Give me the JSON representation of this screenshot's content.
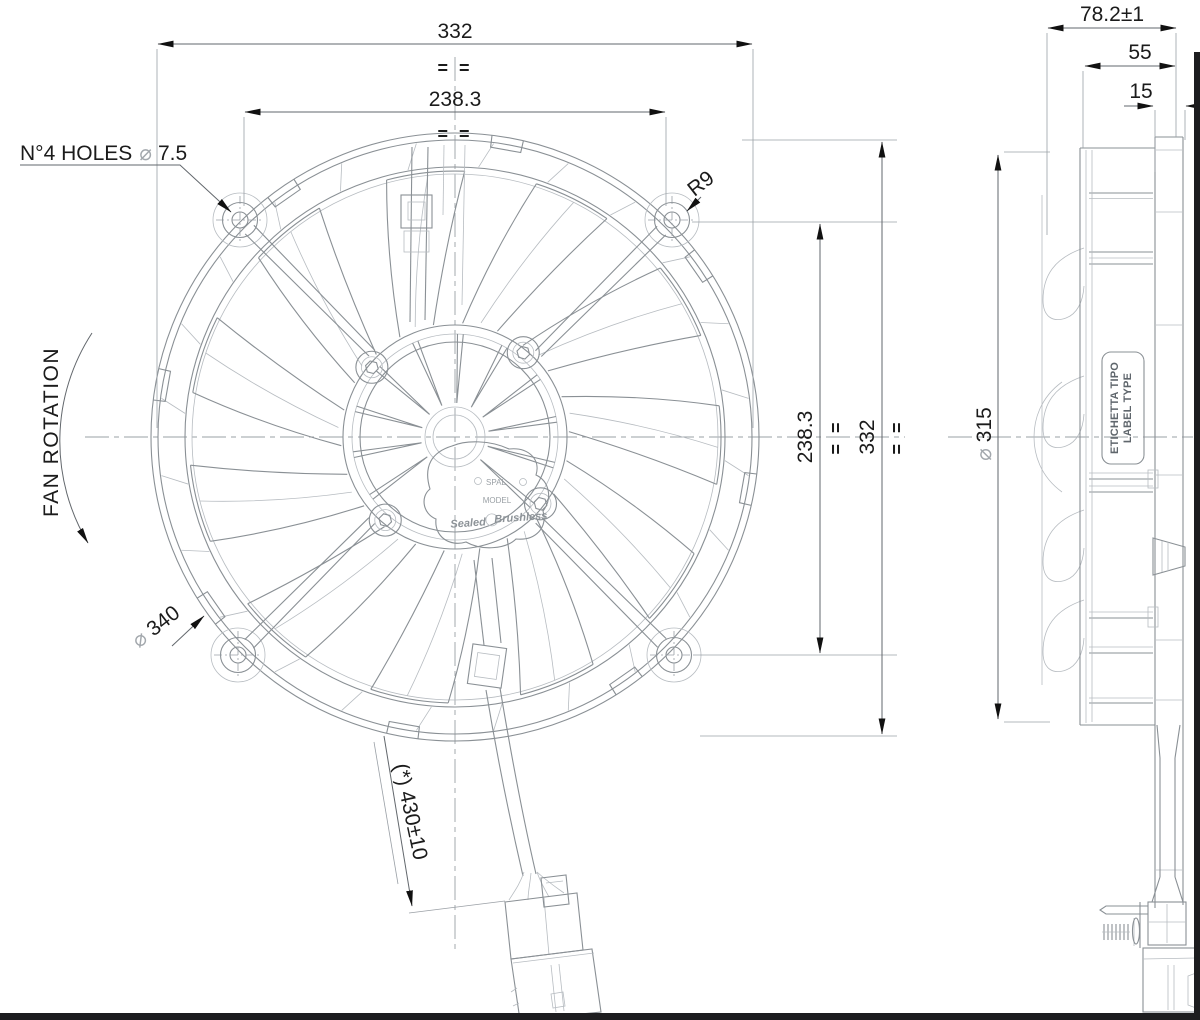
{
  "front_view": {
    "dim_width_outer": "332",
    "dim_width_holes": "238.3",
    "dim_height_holes": "238.3",
    "dim_height_outer": "332",
    "eq_mark": "= =",
    "holes_note_prefix": "N°4 HOLES",
    "dia_symbol": "⌀",
    "holes_note_value": "7.5",
    "corner_radius": "R9",
    "rotation_label": "FAN ROTATION",
    "outer_dia_value": "340",
    "cable_length": "(*) 430±10",
    "hub": {
      "brand": "SPAL",
      "model": "MODEL",
      "tag_left": "Sealed",
      "tag_right": "Brushless"
    }
  },
  "side_view": {
    "dim_depth_total": "78.2±1",
    "dim_depth_body": "55",
    "dim_depth_motor": "15",
    "dia_symbol": "⌀",
    "blade_dia_value": "315",
    "label_line1": "ETICHETTA TIPO",
    "label_line2": "LABEL TYPE"
  }
}
